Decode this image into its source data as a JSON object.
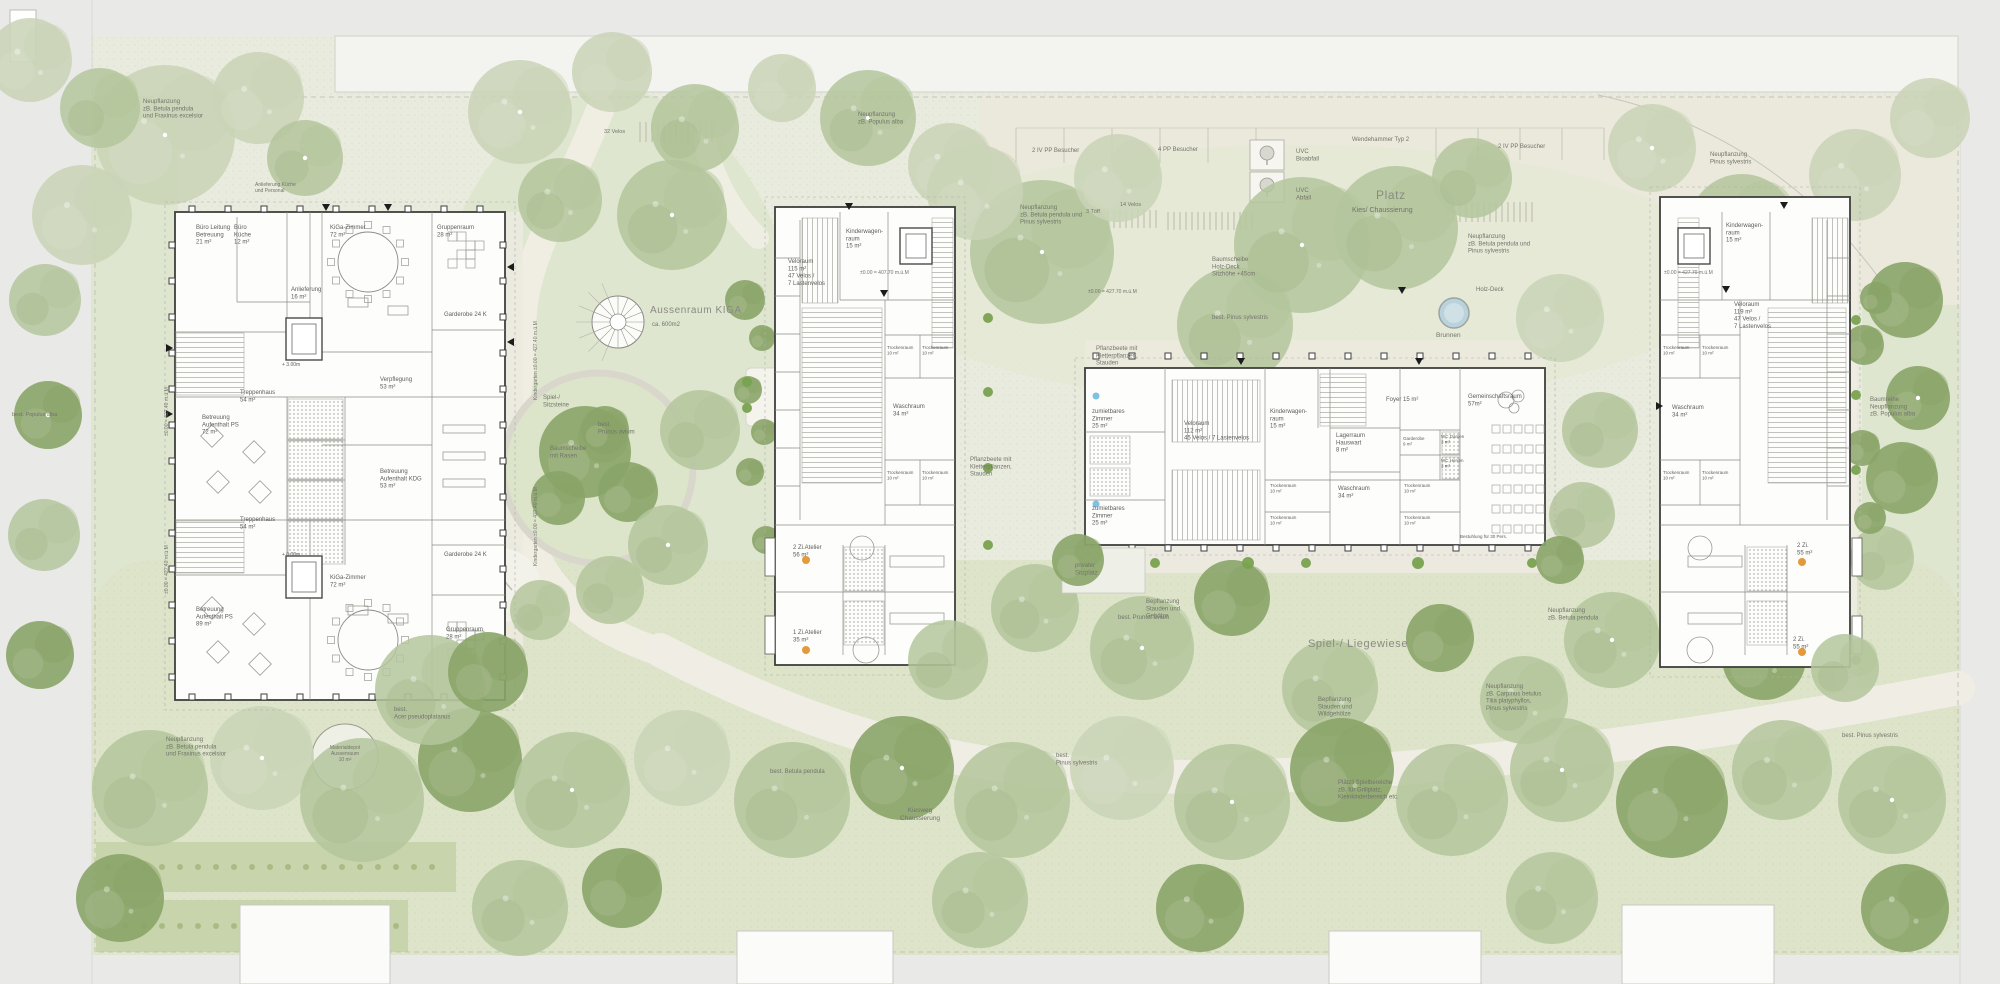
{
  "plan": {
    "type": "architectural-site-plan",
    "description_labels_language": "de",
    "palette": {
      "margin": "#e9e9e7",
      "site_base": "#e8ebdd",
      "lawn_dark": "#dde4c9",
      "garden": "#dfe6cf",
      "platz": "#ebe9db",
      "path": "#f0eee4",
      "hedge": "#c8d4ab",
      "canopy": "#c9d4b6",
      "tree_mid": "#b4c59c",
      "tree_dark": "#8aa468",
      "shrub": "#79a24f",
      "building_fill": "#fdfdfb",
      "wall": "#3f3f3d",
      "water": "#b9d2dc",
      "accent_orange": "#e39a3b",
      "accent_blue": "#7fc0e3"
    }
  },
  "buildings": [
    {
      "id": "kiga",
      "name": "Kindergarten",
      "x": 175,
      "y": 212,
      "w": 330,
      "h": 488
    },
    {
      "id": "haus_west",
      "name": "Wohnhaus West",
      "x": 775,
      "y": 207,
      "w": 180,
      "h": 458
    },
    {
      "id": "haus_mitte",
      "name": "Gemeinschaftshaus Mitte",
      "x": 1085,
      "y": 368,
      "w": 460,
      "h": 177
    },
    {
      "id": "haus_ost",
      "name": "Wohnhaus Ost",
      "x": 1660,
      "y": 197,
      "w": 190,
      "h": 470
    }
  ],
  "site_features": [
    "spiral-stair",
    "play-circle-baumscheibe",
    "sandpit",
    "material-depot-circle",
    "fountain-brunnen",
    "uvc-bioabfall-box",
    "uvc-abfall-box",
    "parking-markings",
    "velo-racks",
    "hedges",
    "walkways"
  ],
  "site_labels": [
    {
      "t": "Neupflanzung\nzB. Betula pendula\nund Fraxinus excelsior",
      "x": 143,
      "y": 103
    },
    {
      "t": "Anlieferung Küche\nund Personal",
      "x": 255,
      "y": 186,
      "s": 5
    },
    {
      "t": "32 Velos",
      "x": 604,
      "y": 133,
      "s": 5.5
    },
    {
      "t": "Neupflanzung\nzB. Populus alba",
      "x": 858,
      "y": 116
    },
    {
      "t": "Aussenraum KIGA",
      "x": 650,
      "y": 313,
      "s": 10,
      "c": "big"
    },
    {
      "t": "ca. 600m2",
      "x": 652,
      "y": 326
    },
    {
      "t": "Spiel-/\nSitzsteine",
      "x": 543,
      "y": 399
    },
    {
      "t": "best.\nPrunus avium",
      "x": 598,
      "y": 426
    },
    {
      "t": "Baumscheibe\nmit Rasen",
      "x": 550,
      "y": 450
    },
    {
      "t": "2 IV PP Besucher",
      "x": 1032,
      "y": 152
    },
    {
      "t": "4 PP Besucher",
      "x": 1158,
      "y": 151
    },
    {
      "t": "UVC\nBioabfall",
      "x": 1296,
      "y": 153
    },
    {
      "t": "UVC\nAbfall",
      "x": 1296,
      "y": 192
    },
    {
      "t": "Wendehammer Typ 2",
      "x": 1352,
      "y": 141
    },
    {
      "t": "2 IV PP Besucher",
      "x": 1498,
      "y": 148
    },
    {
      "t": "3 Töff",
      "x": 1086,
      "y": 213,
      "s": 5.5
    },
    {
      "t": "14 Velos",
      "x": 1120,
      "y": 206,
      "s": 5.5
    },
    {
      "t": "Platz",
      "x": 1376,
      "y": 199,
      "s": 12,
      "c": "big"
    },
    {
      "t": "Kies/ Chaussierung",
      "x": 1352,
      "y": 212,
      "s": 7
    },
    {
      "t": "Neupflanzung\nzB. Betula pendula und\nPinus sylvestris",
      "x": 1020,
      "y": 209
    },
    {
      "t": "Neupflanzung\nPinus sylvestris",
      "x": 1710,
      "y": 156
    },
    {
      "t": "Neupflanzung\nzB. Betula pendula und\nPinus sylvestris",
      "x": 1468,
      "y": 238
    },
    {
      "t": "Baumscheibe\nHolz-Deck\nSitzhöhe +45cm",
      "x": 1212,
      "y": 261
    },
    {
      "t": "best. Pinus sylvestris",
      "x": 1212,
      "y": 319
    },
    {
      "t": "Holz-Deck",
      "x": 1476,
      "y": 291
    },
    {
      "t": "Brunnen",
      "x": 1436,
      "y": 337,
      "s": 6.5
    },
    {
      "t": "Pflanzbeete mit\nKletterpflanzen,\nStauden",
      "x": 970,
      "y": 461
    },
    {
      "t": "Pflanzbeete mit\nKletterpflanzen,\nStauden",
      "x": 1096,
      "y": 350
    },
    {
      "t": "privater\nSitzplatz",
      "x": 1075,
      "y": 567
    },
    {
      "t": "Bepflanzung\nStauden und\nGehölze",
      "x": 1146,
      "y": 603
    },
    {
      "t": "Spiel-/ Liegewiese",
      "x": 1308,
      "y": 647,
      "s": 11,
      "c": "big"
    },
    {
      "t": "Bepflanzung\nStauden und\nWildgehölze",
      "x": 1318,
      "y": 701
    },
    {
      "t": "Neupflanzung\nzB. Carpinus betulus\nTilia platyphyllos,\nPinus sylvestris",
      "x": 1486,
      "y": 688
    },
    {
      "t": "Neupflanzung\nzB. Betula pendula",
      "x": 1548,
      "y": 612
    },
    {
      "t": "best. Prunus avium",
      "x": 1118,
      "y": 619
    },
    {
      "t": "best. Betula pendula",
      "x": 770,
      "y": 773
    },
    {
      "t": "Kiesweg\nChaussierung",
      "x": 920,
      "y": 812,
      "a": "m",
      "s": 6.5
    },
    {
      "t": "Plätzli Spielbereiche\nzB. für Grillplatz,\nKleinkinderbereich etc.",
      "x": 1338,
      "y": 784
    },
    {
      "t": "best.\nAcer pseudoplatanus",
      "x": 394,
      "y": 711
    },
    {
      "t": "Neupflanzung\nzB. Betula pendula\nund Fraxinus excelsior",
      "x": 166,
      "y": 741
    },
    {
      "t": "Materialdepot\nAussenraum\n10 m²",
      "x": 345,
      "y": 749,
      "a": "m",
      "s": 5
    },
    {
      "t": "best. Populus alba",
      "x": 12,
      "y": 416,
      "s": 5.5
    },
    {
      "t": "Baumreihe\nNeupflanzung\nzB. Populus alba",
      "x": 1870,
      "y": 401
    },
    {
      "t": "best. Pinus sylvestris",
      "x": 1842,
      "y": 737
    },
    {
      "t": "best.\nPinus sylvestris",
      "x": 1056,
      "y": 757
    },
    {
      "t": "±0.00 = 427.40 m.ü.M",
      "x": 168,
      "y": 436,
      "s": 5,
      "r": -90
    },
    {
      "t": "±0.00 = 427.40 m.ü.M",
      "x": 168,
      "y": 594,
      "s": 5,
      "r": -90
    },
    {
      "t": "Kindergarten ±0.00 = 427.40 m.ü.M",
      "x": 537,
      "y": 400,
      "s": 5,
      "r": -90
    },
    {
      "t": "Kindergarten ±0.00 = 427.40 m.ü.M",
      "x": 537,
      "y": 566,
      "s": 5,
      "r": -90
    },
    {
      "t": "±0.00 = 407.70 m.ü.M",
      "x": 860,
      "y": 274,
      "s": 5
    },
    {
      "t": "±0.00 = 427.70 m.ü.M",
      "x": 1664,
      "y": 274,
      "s": 5
    },
    {
      "t": "±0.00 = 427.70 m.ü.M",
      "x": 1088,
      "y": 293,
      "s": 5
    }
  ],
  "rooms": {
    "kiga": [
      {
        "t": "Büro Leitung\nBetreuung\n21 m²",
        "x": 196,
        "y": 229
      },
      {
        "t": "Büro\nKüche\n12 m²",
        "x": 234,
        "y": 229
      },
      {
        "t": "KiGa-Zimmer\n72 m²",
        "x": 330,
        "y": 229
      },
      {
        "t": "Gruppenraum\n28 m²",
        "x": 437,
        "y": 229
      },
      {
        "t": "Anlieferung\n16 m²",
        "x": 291,
        "y": 291
      },
      {
        "t": "Garderobe 24 K",
        "x": 444,
        "y": 316
      },
      {
        "t": "Treppenhaus\n54 m²",
        "x": 240,
        "y": 394
      },
      {
        "t": "Betreuung\nAufenthalt PS\n72 m²",
        "x": 202,
        "y": 419
      },
      {
        "t": "Verpflegung\n53 m²",
        "x": 380,
        "y": 381
      },
      {
        "t": "Betreuung\nAufenthalt KDG\n53 m²",
        "x": 380,
        "y": 473
      },
      {
        "t": "Treppenhaus\n54 m²",
        "x": 240,
        "y": 521
      },
      {
        "t": "Betreuung\nAufenthalt PS\n89 m²",
        "x": 196,
        "y": 611
      },
      {
        "t": "KiGa-Zimmer\n72 m²",
        "x": 330,
        "y": 579
      },
      {
        "t": "Garderobe 24 K",
        "x": 444,
        "y": 556
      },
      {
        "t": "Gruppenraum\n28 m²",
        "x": 446,
        "y": 631
      },
      {
        "t": "+ 0.00m",
        "x": 282,
        "y": 556,
        "s": 5
      },
      {
        "t": "+ 3.00m",
        "x": 282,
        "y": 366,
        "s": 5
      }
    ],
    "haus_west": [
      {
        "t": "Kinderwagen-\nraum\n15 m²",
        "x": 846,
        "y": 233
      },
      {
        "t": "Veloraum\n115 m²\n47 Velos /\n7 Lastenvelos",
        "x": 788,
        "y": 263
      },
      {
        "t": "Trockenraum\n10 m²",
        "x": 887,
        "y": 349,
        "s": 4.5
      },
      {
        "t": "Trockenraum\n10 m²",
        "x": 922,
        "y": 349,
        "s": 4.5
      },
      {
        "t": "Waschraum\n34 m²",
        "x": 893,
        "y": 408
      },
      {
        "t": "Trockenraum\n10 m²",
        "x": 887,
        "y": 474,
        "s": 4.5
      },
      {
        "t": "Trockenraum\n10 m²",
        "x": 922,
        "y": 474,
        "s": 4.5
      },
      {
        "t": "2 Zi.Atelier\n56 m²",
        "x": 793,
        "y": 549
      },
      {
        "t": "1 Zi.Atelier\n35 m²",
        "x": 793,
        "y": 634
      }
    ],
    "haus_mitte": [
      {
        "t": "zumietbares\nZimmer\n25 m²",
        "x": 1092,
        "y": 413
      },
      {
        "t": "zumietbares\nZimmer\n25 m²",
        "x": 1092,
        "y": 510
      },
      {
        "t": "Veloraum\n112 m²\n45 Velos / 7 Lastenvelos",
        "x": 1184,
        "y": 425
      },
      {
        "t": "Kinderwagen-\nraum\n15 m²",
        "x": 1270,
        "y": 413
      },
      {
        "t": "Lagerraum\nHauswart\n8 m²",
        "x": 1336,
        "y": 437
      },
      {
        "t": "Trockenraum\n10 m²",
        "x": 1270,
        "y": 487,
        "s": 4.5
      },
      {
        "t": "Trockenraum\n10 m²",
        "x": 1270,
        "y": 519,
        "s": 4.5
      },
      {
        "t": "Waschraum\n34 m²",
        "x": 1338,
        "y": 490
      },
      {
        "t": "Foyer 15 m²",
        "x": 1386,
        "y": 401
      },
      {
        "t": "Garderobe\n9 m²",
        "x": 1403,
        "y": 440,
        "s": 4.5
      },
      {
        "t": "WC Damen\n3 m²",
        "x": 1441,
        "y": 438,
        "s": 4.5
      },
      {
        "t": "WC Herren\n3 m²",
        "x": 1441,
        "y": 462,
        "s": 4.5
      },
      {
        "t": "Gemeinschaftsraum\n57m²",
        "x": 1468,
        "y": 398
      },
      {
        "t": "Trockenraum\n10 m²",
        "x": 1404,
        "y": 487,
        "s": 4.5
      },
      {
        "t": "Trockenraum\n10 m²",
        "x": 1404,
        "y": 519,
        "s": 4.5
      },
      {
        "t": "Bestuhlung für 30 Pers.",
        "x": 1460,
        "y": 538,
        "s": 4.5
      }
    ],
    "haus_ost": [
      {
        "t": "Kinderwagen-\nraum\n15 m²",
        "x": 1726,
        "y": 227
      },
      {
        "t": "Veloraum\n119 m²\n47 Velos /\n7 Lastenvelos",
        "x": 1734,
        "y": 306
      },
      {
        "t": "Trockenraum\n10 m²",
        "x": 1663,
        "y": 349,
        "s": 4.5
      },
      {
        "t": "Trockenraum\n10 m²",
        "x": 1702,
        "y": 349,
        "s": 4.5
      },
      {
        "t": "Waschraum\n34 m²",
        "x": 1672,
        "y": 409
      },
      {
        "t": "Trockenraum\n10 m²",
        "x": 1663,
        "y": 474,
        "s": 4.5
      },
      {
        "t": "Trockenraum\n10 m²",
        "x": 1702,
        "y": 474,
        "s": 4.5
      },
      {
        "t": "2 Zi.\n55 m²",
        "x": 1797,
        "y": 547
      },
      {
        "t": "2 Zi.\n55 m²",
        "x": 1793,
        "y": 641
      }
    ]
  },
  "trees_format": "[x, y, radius, type(0=pale canopy,1=mid green,2=dark green,3=shrub), white_dot, draw_over_buildings]",
  "trees": [
    [
      165,
      135,
      70,
      0,
      1,
      0
    ],
    [
      258,
      98,
      46,
      0,
      0,
      0
    ],
    [
      100,
      108,
      40,
      1,
      0,
      0
    ],
    [
      82,
      215,
      50,
      0,
      0,
      0
    ],
    [
      30,
      60,
      42,
      0,
      0,
      0
    ],
    [
      305,
      158,
      38,
      1,
      1,
      0
    ],
    [
      45,
      300,
      36,
      1,
      0,
      0
    ],
    [
      48,
      415,
      34,
      2,
      1,
      0
    ],
    [
      44,
      535,
      36,
      1,
      0,
      0
    ],
    [
      40,
      655,
      34,
      2,
      0,
      0
    ],
    [
      520,
      112,
      52,
      0,
      1,
      0
    ],
    [
      612,
      72,
      40,
      0,
      0,
      0
    ],
    [
      695,
      128,
      44,
      1,
      0,
      0
    ],
    [
      782,
      88,
      34,
      0,
      0,
      0
    ],
    [
      868,
      118,
      48,
      1,
      1,
      0
    ],
    [
      950,
      165,
      42,
      0,
      0,
      0
    ],
    [
      560,
      200,
      42,
      1,
      0,
      0
    ],
    [
      672,
      215,
      55,
      1,
      1,
      0
    ],
    [
      745,
      300,
      20,
      2,
      0,
      0
    ],
    [
      762,
      338,
      13,
      2,
      0,
      0
    ],
    [
      748,
      390,
      14,
      2,
      0,
      0
    ],
    [
      764,
      432,
      13,
      2,
      0,
      0
    ],
    [
      750,
      472,
      14,
      2,
      0,
      0
    ],
    [
      766,
      540,
      14,
      2,
      0,
      0
    ],
    [
      585,
      452,
      46,
      2,
      0,
      0
    ],
    [
      628,
      492,
      30,
      2,
      0,
      0
    ],
    [
      558,
      498,
      27,
      2,
      0,
      0
    ],
    [
      605,
      430,
      24,
      2,
      0,
      0
    ],
    [
      700,
      430,
      40,
      1,
      0,
      0
    ],
    [
      668,
      545,
      40,
      1,
      1,
      0
    ],
    [
      610,
      590,
      34,
      1,
      0,
      0
    ],
    [
      540,
      610,
      30,
      1,
      0,
      0
    ],
    [
      1042,
      252,
      72,
      1,
      1,
      0
    ],
    [
      975,
      192,
      48,
      0,
      0,
      0
    ],
    [
      1118,
      178,
      44,
      0,
      0,
      0
    ],
    [
      1235,
      325,
      58,
      1,
      0,
      0
    ],
    [
      1302,
      245,
      68,
      1,
      1,
      0
    ],
    [
      1396,
      228,
      62,
      1,
      0,
      0
    ],
    [
      1472,
      178,
      40,
      1,
      0,
      0
    ],
    [
      1560,
      318,
      44,
      0,
      0,
      0
    ],
    [
      1652,
      148,
      44,
      0,
      1,
      0
    ],
    [
      1742,
      228,
      54,
      1,
      0,
      0
    ],
    [
      1855,
      175,
      46,
      0,
      0,
      0
    ],
    [
      1930,
      118,
      40,
      0,
      0,
      0
    ],
    [
      1905,
      300,
      38,
      2,
      0,
      0
    ],
    [
      1918,
      398,
      32,
      2,
      1,
      0
    ],
    [
      1902,
      478,
      36,
      2,
      0,
      0
    ],
    [
      1882,
      558,
      32,
      1,
      0,
      0
    ],
    [
      1864,
      345,
      20,
      2,
      0,
      0
    ],
    [
      1876,
      298,
      16,
      2,
      0,
      0
    ],
    [
      1862,
      448,
      18,
      2,
      0,
      0
    ],
    [
      1870,
      518,
      16,
      2,
      0,
      0
    ],
    [
      1600,
      430,
      38,
      1,
      0,
      0
    ],
    [
      1582,
      515,
      33,
      1,
      0,
      0
    ],
    [
      1035,
      608,
      44,
      1,
      0,
      0
    ],
    [
      1142,
      648,
      52,
      1,
      1,
      1
    ],
    [
      1232,
      598,
      38,
      2,
      0,
      0
    ],
    [
      1330,
      688,
      48,
      1,
      0,
      0
    ],
    [
      1440,
      638,
      34,
      2,
      0,
      0
    ],
    [
      1524,
      700,
      44,
      1,
      0,
      0
    ],
    [
      1612,
      640,
      48,
      1,
      1,
      0
    ],
    [
      1702,
      598,
      38,
      1,
      0,
      0
    ],
    [
      1764,
      658,
      42,
      2,
      0,
      0
    ],
    [
      150,
      788,
      58,
      1,
      0,
      0
    ],
    [
      262,
      758,
      52,
      0,
      1,
      0
    ],
    [
      362,
      800,
      62,
      1,
      0,
      0
    ],
    [
      470,
      760,
      52,
      2,
      0,
      0
    ],
    [
      572,
      790,
      58,
      1,
      1,
      0
    ],
    [
      682,
      758,
      48,
      0,
      0,
      0
    ],
    [
      792,
      800,
      58,
      1,
      0,
      0
    ],
    [
      902,
      768,
      52,
      2,
      1,
      0
    ],
    [
      1012,
      800,
      58,
      1,
      0,
      0
    ],
    [
      1122,
      768,
      52,
      0,
      0,
      0
    ],
    [
      1232,
      802,
      58,
      1,
      1,
      0
    ],
    [
      1342,
      770,
      52,
      2,
      0,
      0
    ],
    [
      1452,
      800,
      56,
      1,
      0,
      0
    ],
    [
      1562,
      770,
      52,
      1,
      1,
      0
    ],
    [
      1672,
      802,
      56,
      2,
      0,
      0
    ],
    [
      1782,
      770,
      50,
      1,
      0,
      0
    ],
    [
      1892,
      800,
      54,
      1,
      1,
      0
    ],
    [
      120,
      898,
      44,
      2,
      0,
      0
    ],
    [
      520,
      908,
      48,
      1,
      0,
      0
    ],
    [
      622,
      888,
      40,
      2,
      0,
      0
    ],
    [
      980,
      900,
      48,
      1,
      0,
      0
    ],
    [
      1200,
      908,
      44,
      2,
      0,
      0
    ],
    [
      1552,
      898,
      46,
      1,
      0,
      0
    ],
    [
      1905,
      908,
      44,
      2,
      0,
      0
    ],
    [
      430,
      690,
      55,
      1,
      0,
      1
    ],
    [
      488,
      672,
      40,
      2,
      0,
      1
    ],
    [
      948,
      660,
      40,
      1,
      0,
      1
    ],
    [
      1078,
      560,
      26,
      2,
      0,
      1
    ],
    [
      1560,
      560,
      24,
      2,
      0,
      1
    ],
    [
      1845,
      668,
      34,
      1,
      0,
      1
    ],
    [
      1098,
      563,
      6,
      3,
      0,
      0
    ],
    [
      1155,
      563,
      5,
      3,
      0,
      0
    ],
    [
      1248,
      563,
      6,
      3,
      0,
      0
    ],
    [
      1306,
      563,
      5,
      3,
      0,
      0
    ],
    [
      1418,
      563,
      6,
      3,
      0,
      0
    ],
    [
      1532,
      563,
      5,
      3,
      0,
      0
    ],
    [
      988,
      318,
      5,
      3,
      0,
      0
    ],
    [
      988,
      392,
      5,
      3,
      0,
      0
    ],
    [
      988,
      468,
      5,
      3,
      0,
      0
    ],
    [
      988,
      545,
      5,
      3,
      0,
      0
    ],
    [
      1856,
      320,
      5,
      3,
      0,
      0
    ],
    [
      1856,
      395,
      5,
      3,
      0,
      0
    ],
    [
      1856,
      470,
      5,
      3,
      0,
      0
    ],
    [
      1856,
      660,
      5,
      3,
      0,
      0
    ],
    [
      747,
      382,
      5,
      3,
      0,
      0
    ],
    [
      747,
      408,
      5,
      3,
      0,
      0
    ]
  ]
}
